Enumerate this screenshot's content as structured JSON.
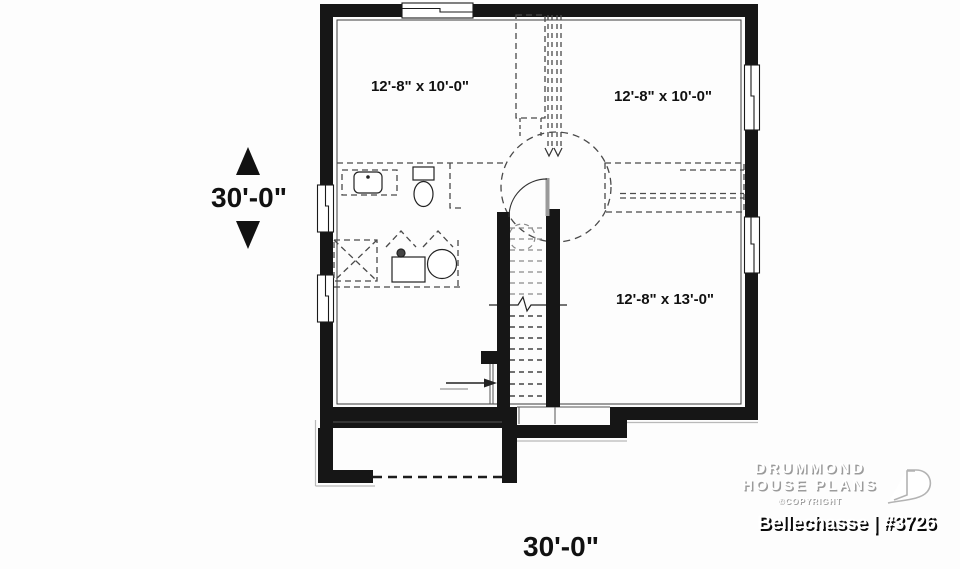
{
  "plan": {
    "dimension_vertical": "30'-0\"",
    "dimension_horizontal": "30'-0\"",
    "rooms": [
      {
        "label": "12'-8\" x 10'-0\""
      },
      {
        "label": "12'-8\" x 10'-0\""
      },
      {
        "label": "12'-8\" x 13'-0\""
      }
    ],
    "fixtures": [
      "sink",
      "toilet",
      "shower",
      "washer",
      "dryer",
      "floor-drain",
      "stairs",
      "chimney-duct"
    ]
  },
  "branding": {
    "name_line1": "DRUMMOND",
    "name_line2": "HOUSE PLANS",
    "copyright": "©COPYRIGHT",
    "plan_title": "Bellechasse | #3726"
  },
  "colors": {
    "wall": "#161616",
    "background": "#fdfdfd",
    "dashed": "#4a4a4a",
    "logo_shadow": "#9b9b9b"
  }
}
